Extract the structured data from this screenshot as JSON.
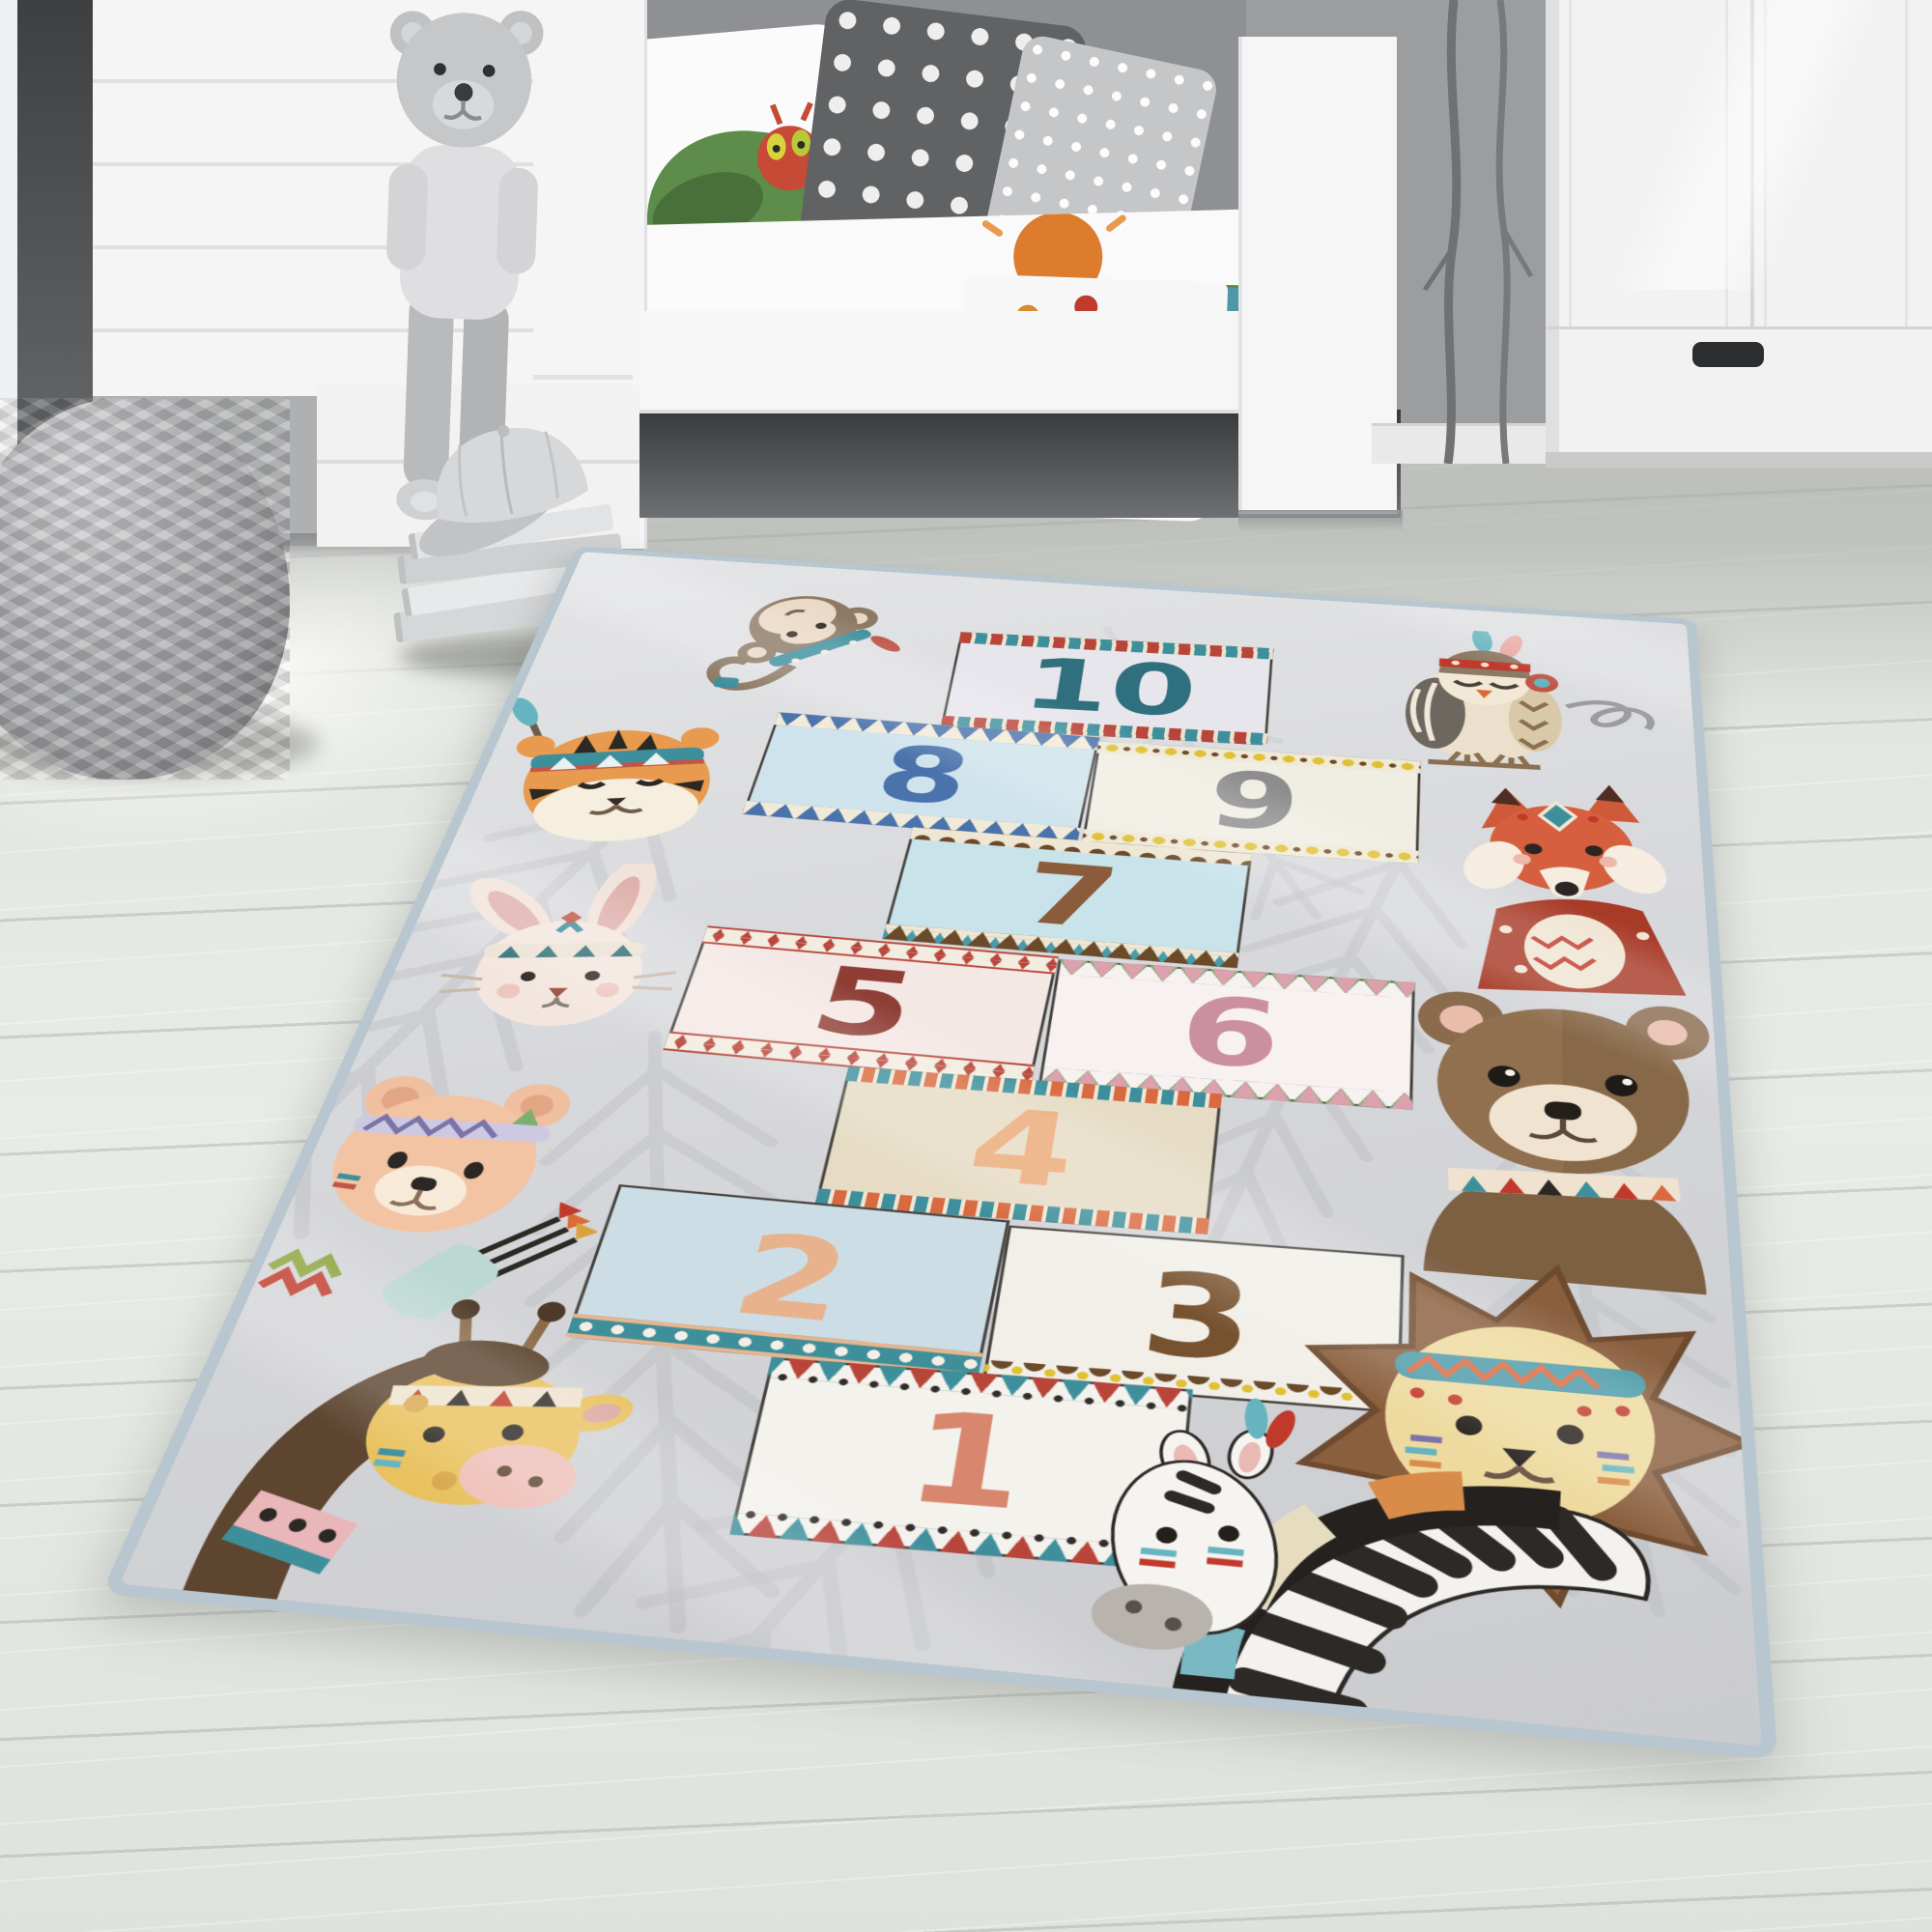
{
  "scene": {
    "subject": "children's room with hopscotch number play rug"
  },
  "room": {
    "wall_color": "#9c9d9f",
    "floor_color": "#e8ebe6",
    "bedding": {
      "duvet_color": "#fafafb",
      "mattress_color": "#4f98a8",
      "pillow_dark_color": "#606264",
      "pillow_light_color": "#c5c6c8"
    }
  },
  "rug": {
    "base_color": "#d8d9dc",
    "edge_color": "#b7c6cf",
    "leaf_color": "#c4c5c9",
    "squares": [
      {
        "number": "1",
        "fill": "#f4f2ed",
        "number_color": "#d8876e",
        "decoration": "red-teal-triangles-with-dots"
      },
      {
        "number": "2",
        "fill": "#cddde6",
        "number_color": "#e7b28c",
        "decoration": "teal-dot-band"
      },
      {
        "number": "3",
        "fill": "#f1efe8",
        "number_color": "#77522f",
        "decoration": "brown-scallops-yellow-dots"
      },
      {
        "number": "4",
        "fill": "#e6dcc5",
        "number_color": "#ecaa78",
        "decoration": "teal-orange-chevrons"
      },
      {
        "number": "5",
        "fill": "#f4e8e5",
        "number_color": "#8e3e35",
        "decoration": "red-diamonds"
      },
      {
        "number": "6",
        "fill": "#f7f2f1",
        "number_color": "#cb8fa0",
        "decoration": "pink-green-triangles"
      },
      {
        "number": "7",
        "fill": "#c9e3ea",
        "number_color": "#8a5c3b",
        "decoration": "brown-scallops-teal-zigzag"
      },
      {
        "number": "8",
        "fill": "#cfe3ec",
        "number_color": "#4a73ab",
        "decoration": "blue-triangles"
      },
      {
        "number": "9",
        "fill": "#f0ede3",
        "number_color": "#8d8d8d",
        "decoration": "yellow-dots"
      },
      {
        "number": "10",
        "fill": "#e8e6ed",
        "number_color": "#2f6f7e",
        "decoration": "red-teal-arrow-band"
      }
    ],
    "animals": [
      {
        "name": "monkey"
      },
      {
        "name": "tiger"
      },
      {
        "name": "rabbit"
      },
      {
        "name": "bear-cub"
      },
      {
        "name": "giraffe"
      },
      {
        "name": "owl"
      },
      {
        "name": "fox"
      },
      {
        "name": "brown-bear"
      },
      {
        "name": "lion"
      },
      {
        "name": "zebra"
      }
    ]
  }
}
